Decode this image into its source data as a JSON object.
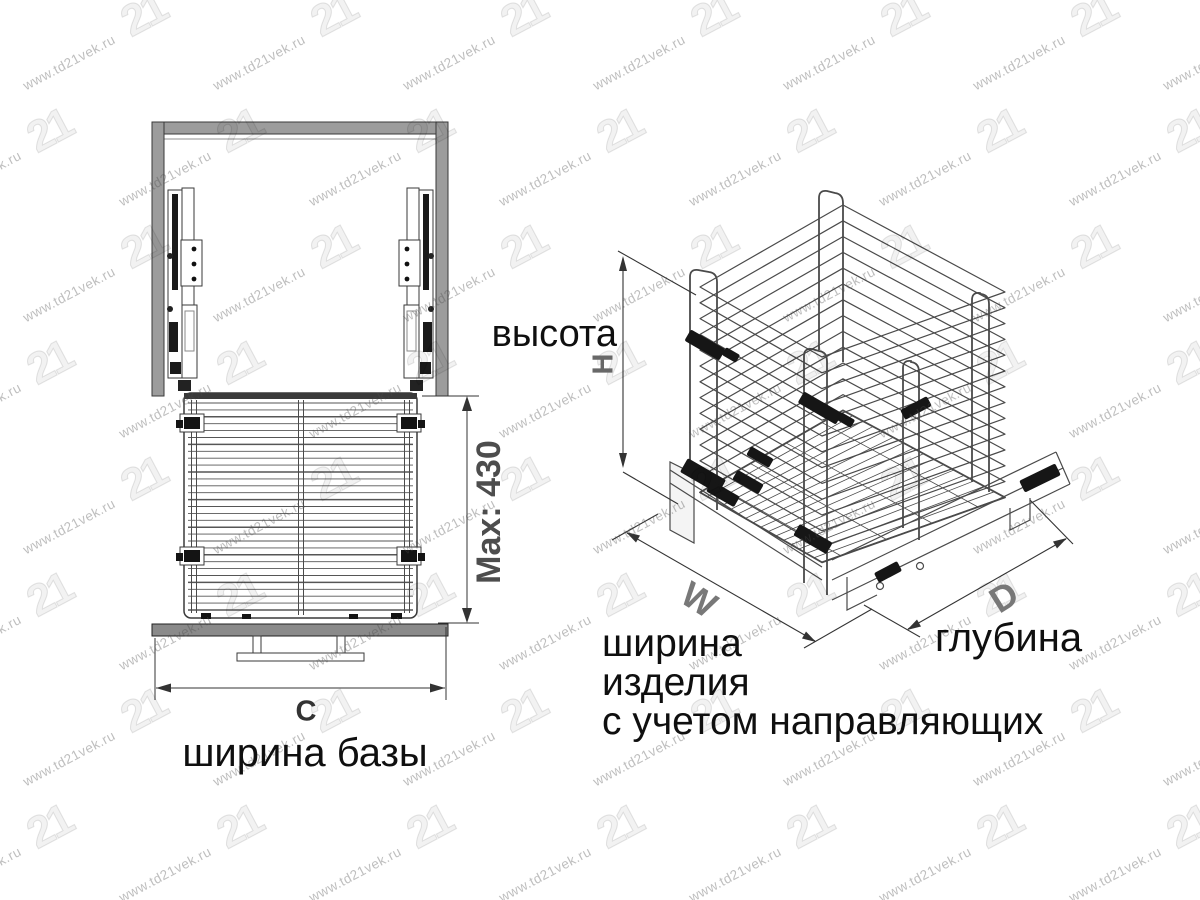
{
  "watermark": {
    "text": "www.td21vek.ru",
    "logo": "21"
  },
  "front_view": {
    "max_height_label": "Max: 430",
    "width_dim_letter": "C",
    "width_caption": "ширина базы"
  },
  "iso_view": {
    "height_caption": "высота",
    "height_dim_letter": "H",
    "width_dim_letter": "W",
    "depth_dim_letter": "D",
    "width_caption_line1": "ширина",
    "width_caption_line2": "изделия",
    "width_caption_line3": "с учетом направляющих",
    "depth_caption": "глубина"
  },
  "colors": {
    "drawing_line": "#3a3a3a",
    "wire_line": "#4a4a4a",
    "dim_line": "#333333",
    "metal_gray": "#9c9c9c",
    "plate_gray": "#8a8a8a",
    "hardware_black": "#161616",
    "label_black": "#0f0f0f",
    "dim_letter_gray": "#787878",
    "watermark_gray": "#a9a9a9"
  }
}
